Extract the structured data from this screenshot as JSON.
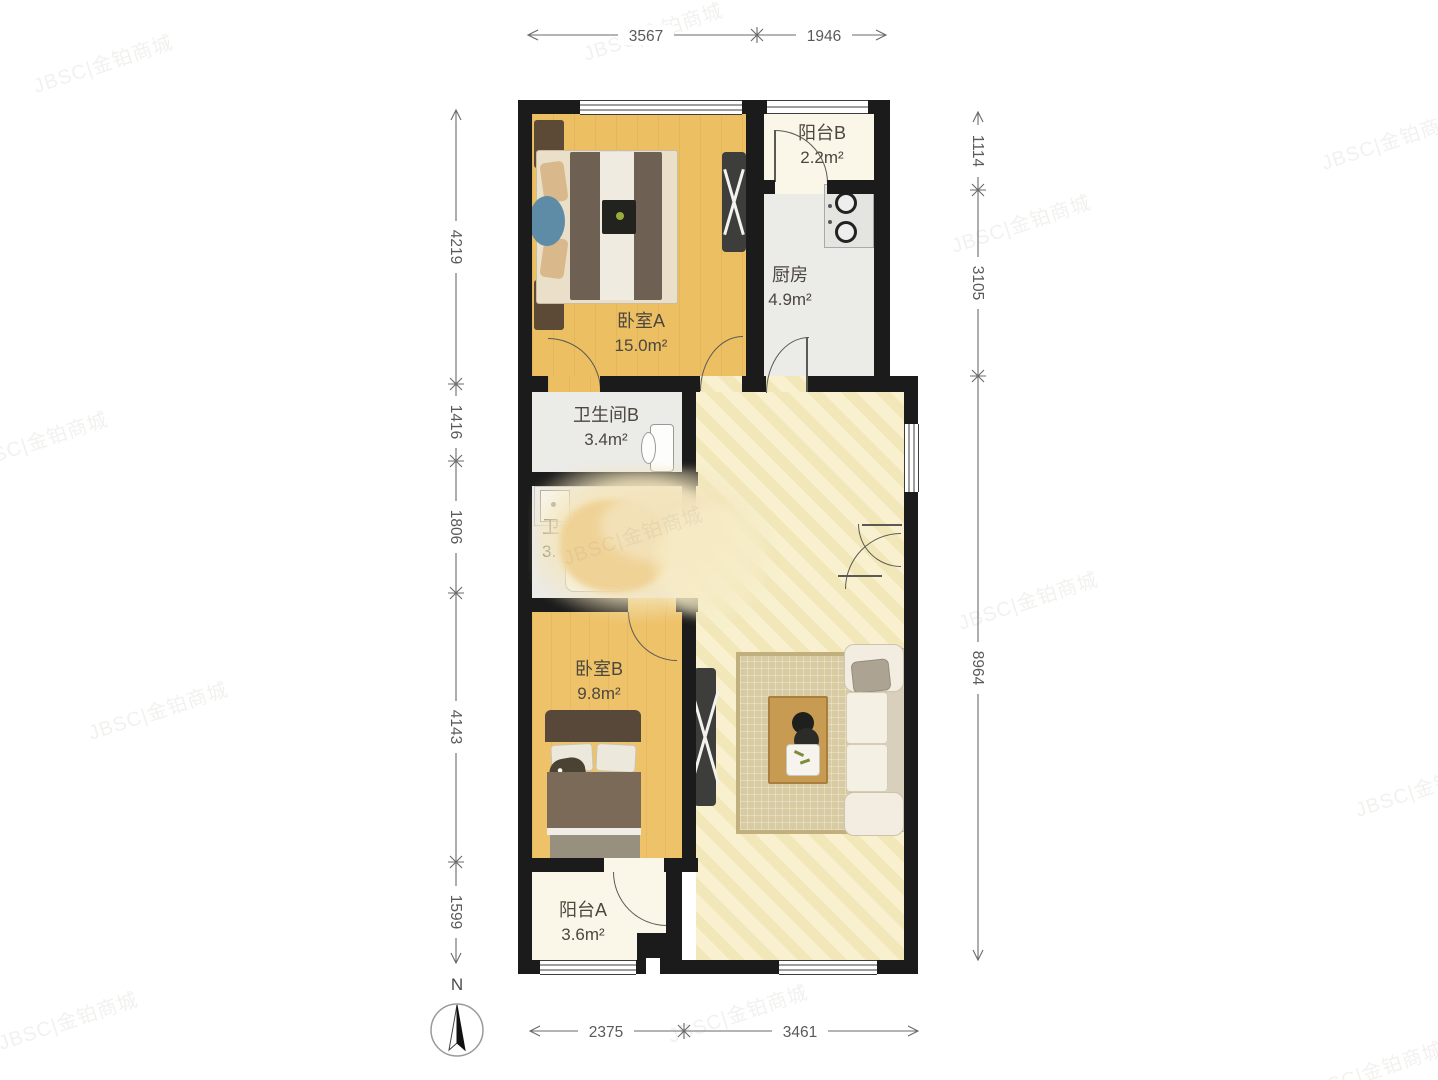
{
  "watermark": {
    "text": "JBSC|金铂商城"
  },
  "compass": {
    "label": "N"
  },
  "rooms": {
    "bedroomA": {
      "name": "卧室A",
      "area": "15.0m²"
    },
    "bedroomB": {
      "name": "卧室B",
      "area": "9.8m²"
    },
    "kitchen": {
      "name": "厨房",
      "area": "4.9m²"
    },
    "bathroomB": {
      "name": "卫生间B",
      "area": "3.4m²"
    },
    "bathroomA": {
      "name": "卫",
      "area": "3."
    },
    "balconyA": {
      "name": "阳台A",
      "area": "3.6m²"
    },
    "balconyB": {
      "name": "阳台B",
      "area": "2.2m²"
    }
  },
  "dimensions": {
    "top": [
      {
        "value": "3567"
      },
      {
        "value": "1946"
      }
    ],
    "bottom": [
      {
        "value": "2375"
      },
      {
        "value": "3461"
      }
    ],
    "left": [
      {
        "value": "4219"
      },
      {
        "value": "1416"
      },
      {
        "value": "1806"
      },
      {
        "value": "4143"
      },
      {
        "value": "1599"
      }
    ],
    "right": [
      {
        "value": "1114"
      },
      {
        "value": "3105"
      },
      {
        "value": "8964"
      }
    ]
  },
  "colors": {
    "wall": "#1b1b1b",
    "wood_floor": "#edbf63",
    "living_floor": "#f6eec6",
    "balcony_floor": "#faf7e8",
    "service_floor": "#ebebe8",
    "dimension_text": "#5a5a5a"
  }
}
